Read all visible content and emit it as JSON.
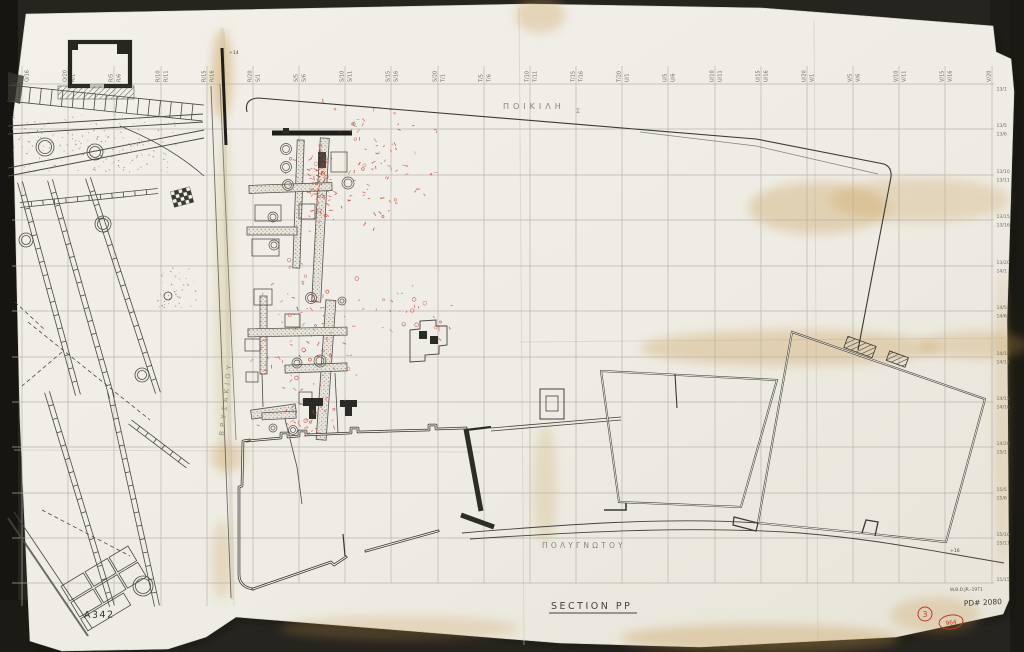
{
  "document": {
    "title": "SECTION PP",
    "sheet_code": "A342",
    "credit": "W.B.D.JR.-1971",
    "drawing_number": "PD# 2080",
    "stamp_circle": "3",
    "stamp_oval": "964"
  },
  "streets": {
    "top_name": "ΠΟΙΚΙΛΗ",
    "top_suffix": "Σ",
    "bottom_name": "ΠΟΛΥΓΝΩΤΟΥ",
    "left_name": "ΒΡΥΣΑΚΙΟΥ"
  },
  "elevations": [
    {
      "label": "+14",
      "x": 229,
      "y": 54
    },
    {
      "label": "+16",
      "x": 950,
      "y": 552
    }
  ],
  "grid": {
    "columns": [
      {
        "x": 22,
        "left": "",
        "right": "Q/16"
      },
      {
        "x": 68,
        "left": "Q/20",
        "right": "R/1"
      },
      {
        "x": 114,
        "left": "R/5",
        "right": "R/6"
      },
      {
        "x": 161,
        "left": "R/10",
        "right": "R/11"
      },
      {
        "x": 207,
        "left": "R/15",
        "right": "R/16"
      },
      {
        "x": 253,
        "left": "R/20",
        "right": "S/1"
      },
      {
        "x": 299,
        "left": "S/5",
        "right": "S/6"
      },
      {
        "x": 345,
        "left": "S/10",
        "right": "S/11"
      },
      {
        "x": 391,
        "left": "S/15",
        "right": "S/16"
      },
      {
        "x": 438,
        "left": "S/20",
        "right": "T/1"
      },
      {
        "x": 484,
        "left": "T/5",
        "right": "T/6"
      },
      {
        "x": 530,
        "left": "T/10",
        "right": "T/11"
      },
      {
        "x": 576,
        "left": "T/15",
        "right": "T/16"
      },
      {
        "x": 622,
        "left": "T/20",
        "right": "U/1"
      },
      {
        "x": 668,
        "left": "U/5",
        "right": "U/6"
      },
      {
        "x": 715,
        "left": "U/10",
        "right": "U/11"
      },
      {
        "x": 761,
        "left": "U/15",
        "right": "U/16"
      },
      {
        "x": 807,
        "left": "U/20",
        "right": "V/1"
      },
      {
        "x": 853,
        "left": "V/5",
        "right": "V/6"
      },
      {
        "x": 899,
        "left": "V/10",
        "right": "V/11"
      },
      {
        "x": 945,
        "left": "V/15",
        "right": "V/16"
      },
      {
        "x": 992,
        "left": "V/20",
        "right": ""
      }
    ],
    "rows": [
      {
        "y": 84,
        "above": "",
        "below": "13/1"
      },
      {
        "y": 129,
        "above": "13/5",
        "below": "13/6"
      },
      {
        "y": 175,
        "above": "13/10",
        "below": "13/11"
      },
      {
        "y": 220,
        "above": "13/15",
        "below": "13/16"
      },
      {
        "y": 266,
        "above": "13/20",
        "below": "14/1"
      },
      {
        "y": 311,
        "above": "14/5",
        "below": "14/6"
      },
      {
        "y": 357,
        "above": "14/10",
        "below": "14/11"
      },
      {
        "y": 402,
        "above": "14/15",
        "below": "14/16"
      },
      {
        "y": 447,
        "above": "14/20",
        "below": "15/1"
      },
      {
        "y": 493,
        "above": "15/5",
        "below": "15/6"
      },
      {
        "y": 538,
        "above": "15/10",
        "below": "15/11"
      },
      {
        "y": 583,
        "above": "15/15",
        "below": ""
      }
    ]
  },
  "red_annotations": {
    "color": "#c0392b",
    "clusters": [
      {
        "x": 278,
        "y": 96,
        "w": 175,
        "h": 135,
        "n": 95
      },
      {
        "x": 306,
        "y": 135,
        "w": 28,
        "h": 100,
        "n": 70
      },
      {
        "x": 243,
        "y": 248,
        "w": 125,
        "h": 205,
        "n": 85
      },
      {
        "x": 355,
        "y": 278,
        "w": 75,
        "h": 65,
        "n": 16
      },
      {
        "x": 282,
        "y": 398,
        "w": 55,
        "h": 45,
        "n": 26
      },
      {
        "x": 415,
        "y": 300,
        "w": 40,
        "h": 45,
        "n": 10
      }
    ]
  },
  "colors": {
    "background": "#23221d",
    "paper": "#f0eee6",
    "ink": "#3a3833",
    "grid_line": "#b5b1a6",
    "stain": "#c89a4e",
    "faint_text": "#8a867a"
  }
}
